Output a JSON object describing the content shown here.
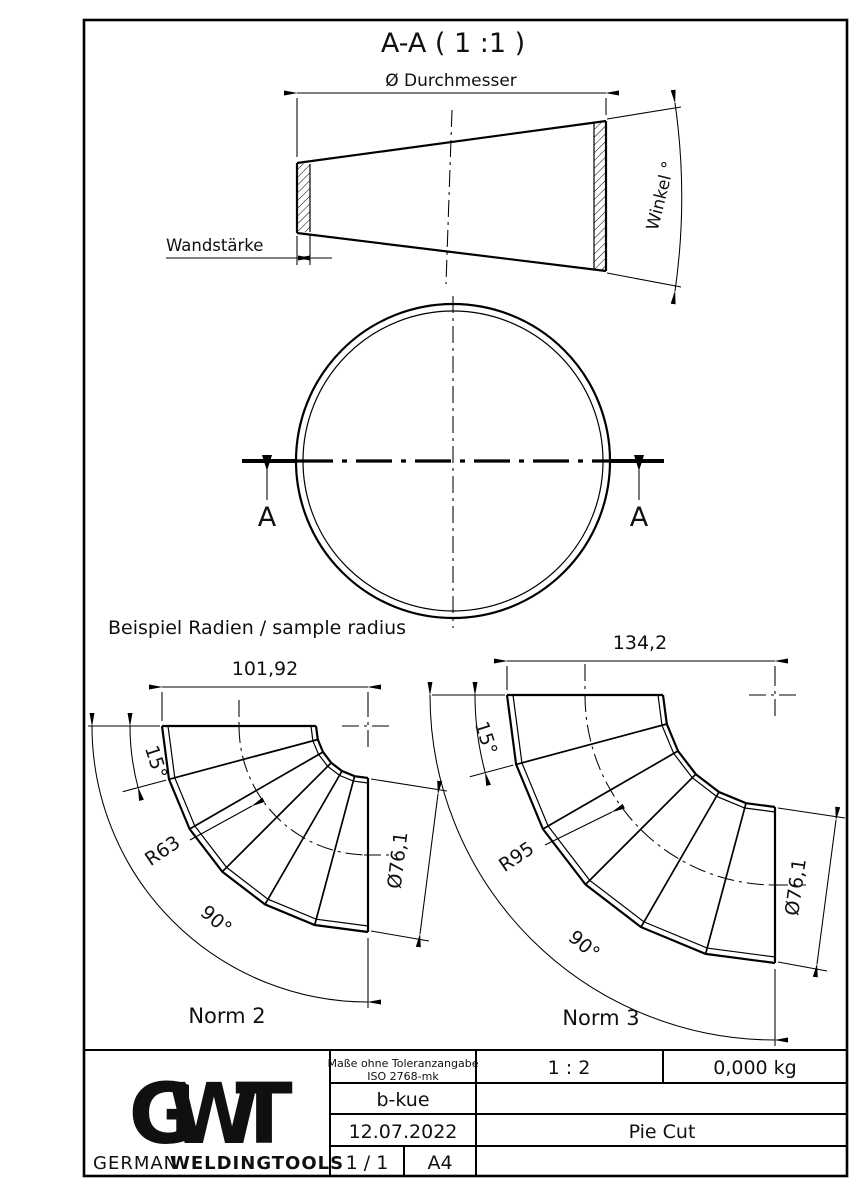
{
  "sheet": {
    "bg": "#ffffff",
    "line_color": "#000000"
  },
  "section_view": {
    "title": "A-A ( 1 :1 )",
    "diameter_label": "Ø Durchmesser",
    "wall_label": "Wandstärke",
    "angle_label": "Winkel °"
  },
  "circle_view": {
    "marker_left": "A",
    "marker_right": "A"
  },
  "samples": {
    "heading": "Beispiel Radien / sample radius",
    "norm2": {
      "name": "Norm 2",
      "length": "101,92",
      "radius": "R63",
      "segment_angle": "15°",
      "bend_angle": "90°",
      "diameter": "Ø76,1"
    },
    "norm3": {
      "name": "Norm 3",
      "length": "134,2",
      "radius": "R95",
      "segment_angle": "15°",
      "bend_angle": "90°",
      "diameter": "Ø76,1"
    }
  },
  "title_block": {
    "tolerance_line1": "Maße ohne Toleranzangabe",
    "tolerance_line2": "ISO 2768-mk",
    "scale": "1 : 2",
    "weight": "0,000 kg",
    "drawn_by": "b-kue",
    "date": "12.07.2022",
    "part_name": "Pie Cut",
    "sheet_no": "1 / 1",
    "format": "A4",
    "logo": {
      "g": "G",
      "w": "W",
      "t": "T",
      "sub_light": "GERMAN",
      "sub_bold": "WELDINGTOOLS"
    }
  }
}
